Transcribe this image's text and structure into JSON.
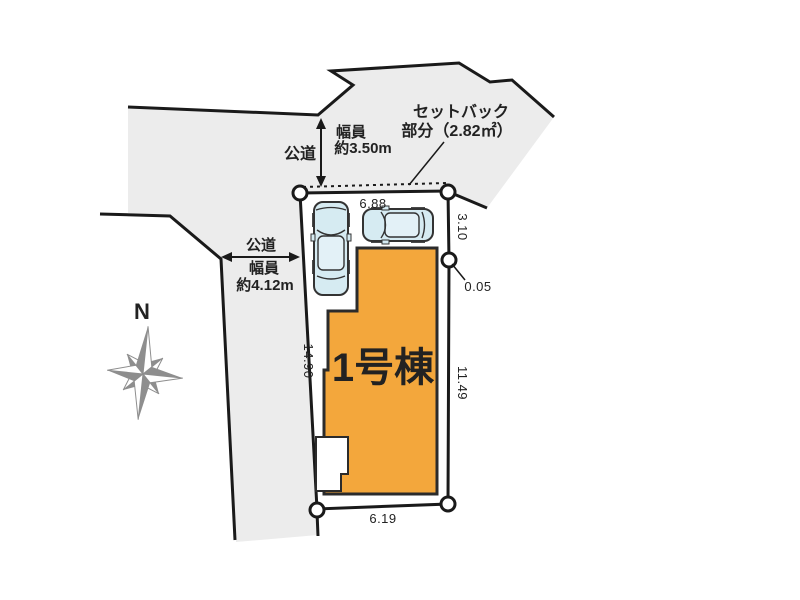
{
  "annotations": {
    "setback": {
      "line1": "セットバック",
      "line2": "部分（2.82㎡）"
    },
    "road_top": {
      "name": "公道",
      "width_label": "幅員",
      "width_value": "約3.50m"
    },
    "road_left": {
      "name": "公道",
      "width_label": "幅員",
      "width_value": "約4.12m"
    }
  },
  "building": {
    "label": "1号棟"
  },
  "compass": {
    "north": "N"
  },
  "dimensions": {
    "top": "6.88",
    "right_upper": "3.10",
    "right_offset": "0.05",
    "right_lower": "11.49",
    "left": "14.90",
    "bottom": "6.19"
  },
  "colors": {
    "building_fill": "#F3A73C",
    "area_fill": "#ECECEC",
    "outline": "#1A1A1A",
    "car_fill": "#D6EBF2",
    "compass_gray": "#8E8E8E",
    "text": "#222222"
  }
}
